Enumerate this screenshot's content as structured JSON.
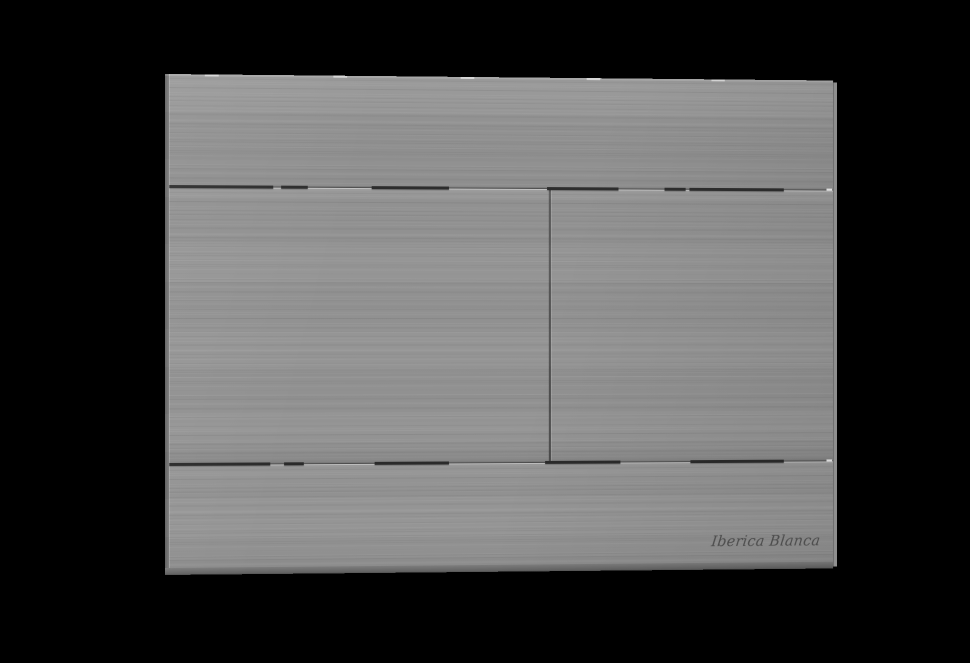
{
  "backdrop": {
    "color": "#000000"
  },
  "plate": {
    "finish": "brushed-gray-metal",
    "base_color": "#949494",
    "groove_color": "#2b2b2b",
    "divider_color": "#565656",
    "edge_shadow_color": "#626262",
    "edge_highlight_color": "#ededed",
    "brand": {
      "label": "Iberica Blanca",
      "text_color": "#4e4e4e"
    }
  }
}
